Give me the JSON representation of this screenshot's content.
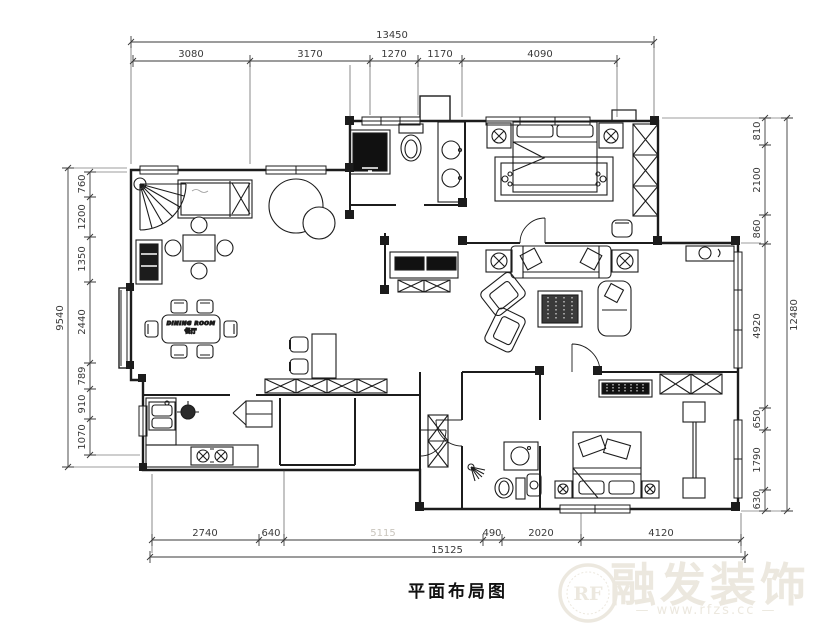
{
  "title": "平面布局图",
  "watermark": {
    "logo_text": "RF",
    "brand_text": "融发装饰",
    "site_text": "— www.rfzs.cc —"
  },
  "room_labels": {
    "dining_line1": "DINING ROOM",
    "dining_line2": "餐厅"
  },
  "dimensions": {
    "top": {
      "total": "13450",
      "segments": [
        "3080",
        "3170",
        "1270",
        "1170",
        "4090"
      ]
    },
    "left": {
      "total": "9540",
      "segments": [
        "760",
        "1200",
        "1350",
        "2440",
        "789",
        "910",
        "1070"
      ]
    },
    "right": {
      "total": "12480",
      "segments": [
        "810",
        "2100",
        "860",
        "4920",
        "650",
        "1790",
        "630"
      ]
    },
    "bottom": {
      "total": "15125",
      "segments": [
        "2740",
        "640",
        "5115",
        "490",
        "2020",
        "4120"
      ]
    }
  },
  "colors": {
    "line": "#1c1c1c",
    "dimension_text": "#3a3a3a",
    "faint_dimension": "#c9c5bd",
    "watermark": "#ece8df",
    "background": "#ffffff"
  }
}
